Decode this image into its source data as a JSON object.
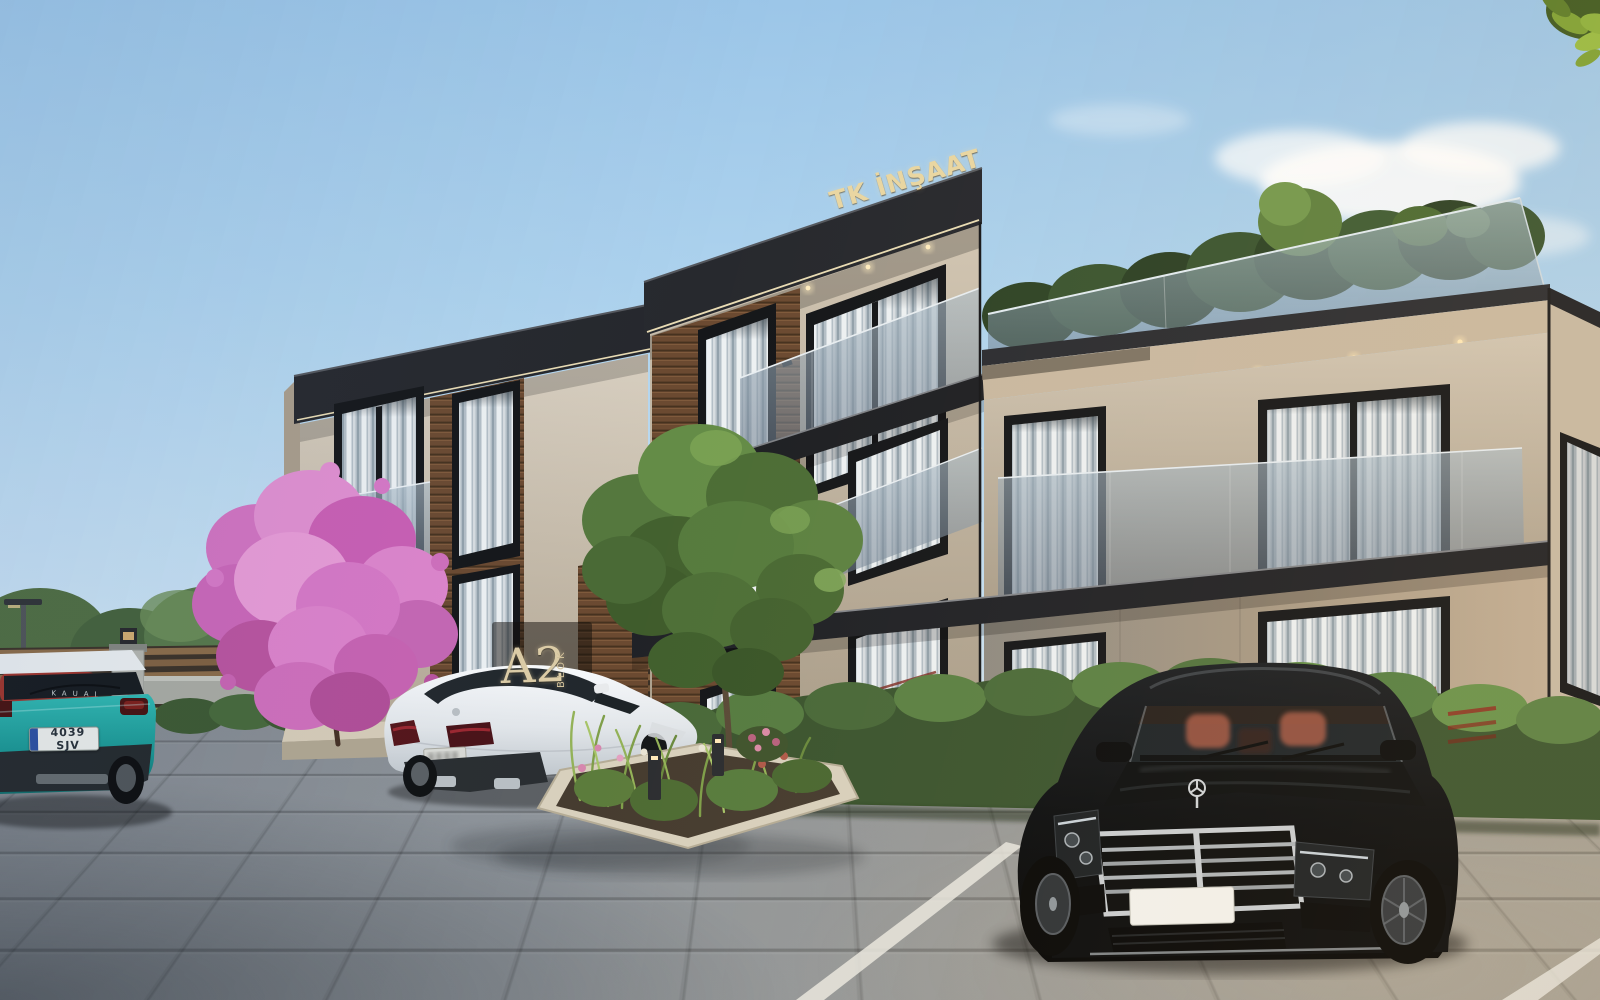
{
  "scene": {
    "description": "Architectural exterior render of a modern three-storey residential complex (TK İNŞAAT project, block A2) with landscaped parking lot, pink blossom tree and three parked cars under a clear blue sky",
    "developer_sign": "TK İNŞAAT",
    "block_sign": "A2",
    "block_sign_vertical": "BLOK",
    "vehicles": [
      {
        "id": "teal-suv",
        "type": "compact SUV seen from rear, far left, partly cropped",
        "color": "#1ca8a4",
        "model_text": "KAUAI",
        "license_plate": "4039 SJV"
      },
      {
        "id": "white-coupe",
        "type": "white coupe sedan seen from rear three-quarter",
        "color": "#eef0f3",
        "license_plate": ""
      },
      {
        "id": "black-sedan",
        "type": "black luxury sedan with chrome grille seen from front",
        "color": "#0b0d10",
        "license_plate": ""
      },
      {
        "id": "red-car",
        "type": "red car sliver behind teal SUV",
        "color": "#9e332a",
        "license_plate": ""
      }
    ],
    "building": {
      "storeys": 3,
      "features": [
        "flat dark roof fascia with LED strip",
        "rooftop terrace with glass parapet and plants",
        "wood slat cladding",
        "beige textured stucco",
        "stone clad ground floor",
        "glass balconies",
        "recessed soffit downlights",
        "sheer white curtains in windows"
      ]
    },
    "landscape": [
      "pink blossom tree in planter",
      "green deciduous tree",
      "ornamental grass island with curb",
      "boxwood hedges",
      "background tree line",
      "horizontal slat wooden fence",
      "stone gate pillar with lamp",
      "street lamp",
      "bollard path lights",
      "overhanging leaves top right corner"
    ],
    "ground": {
      "type": "grey paver parking lot",
      "markings": "white parking stall lines"
    },
    "palette": {
      "sky_top": "#9cc6e8",
      "sky_horizon": "#dce9f4",
      "roof_fascia": "#27292e",
      "led_strip": "#f4e6bc",
      "stucco": "#c9bead",
      "wood_cladding": "#6b4a31",
      "ground_stone": "#a89a86",
      "glass_rail": "#9fb2c0",
      "hedge_green": "#49693a",
      "blossom_pink": "#d678c6",
      "pavement_grey": "#9aa0a6",
      "curb_stone": "#d8d0bd",
      "sign_gold": "#e8d5a2"
    }
  }
}
